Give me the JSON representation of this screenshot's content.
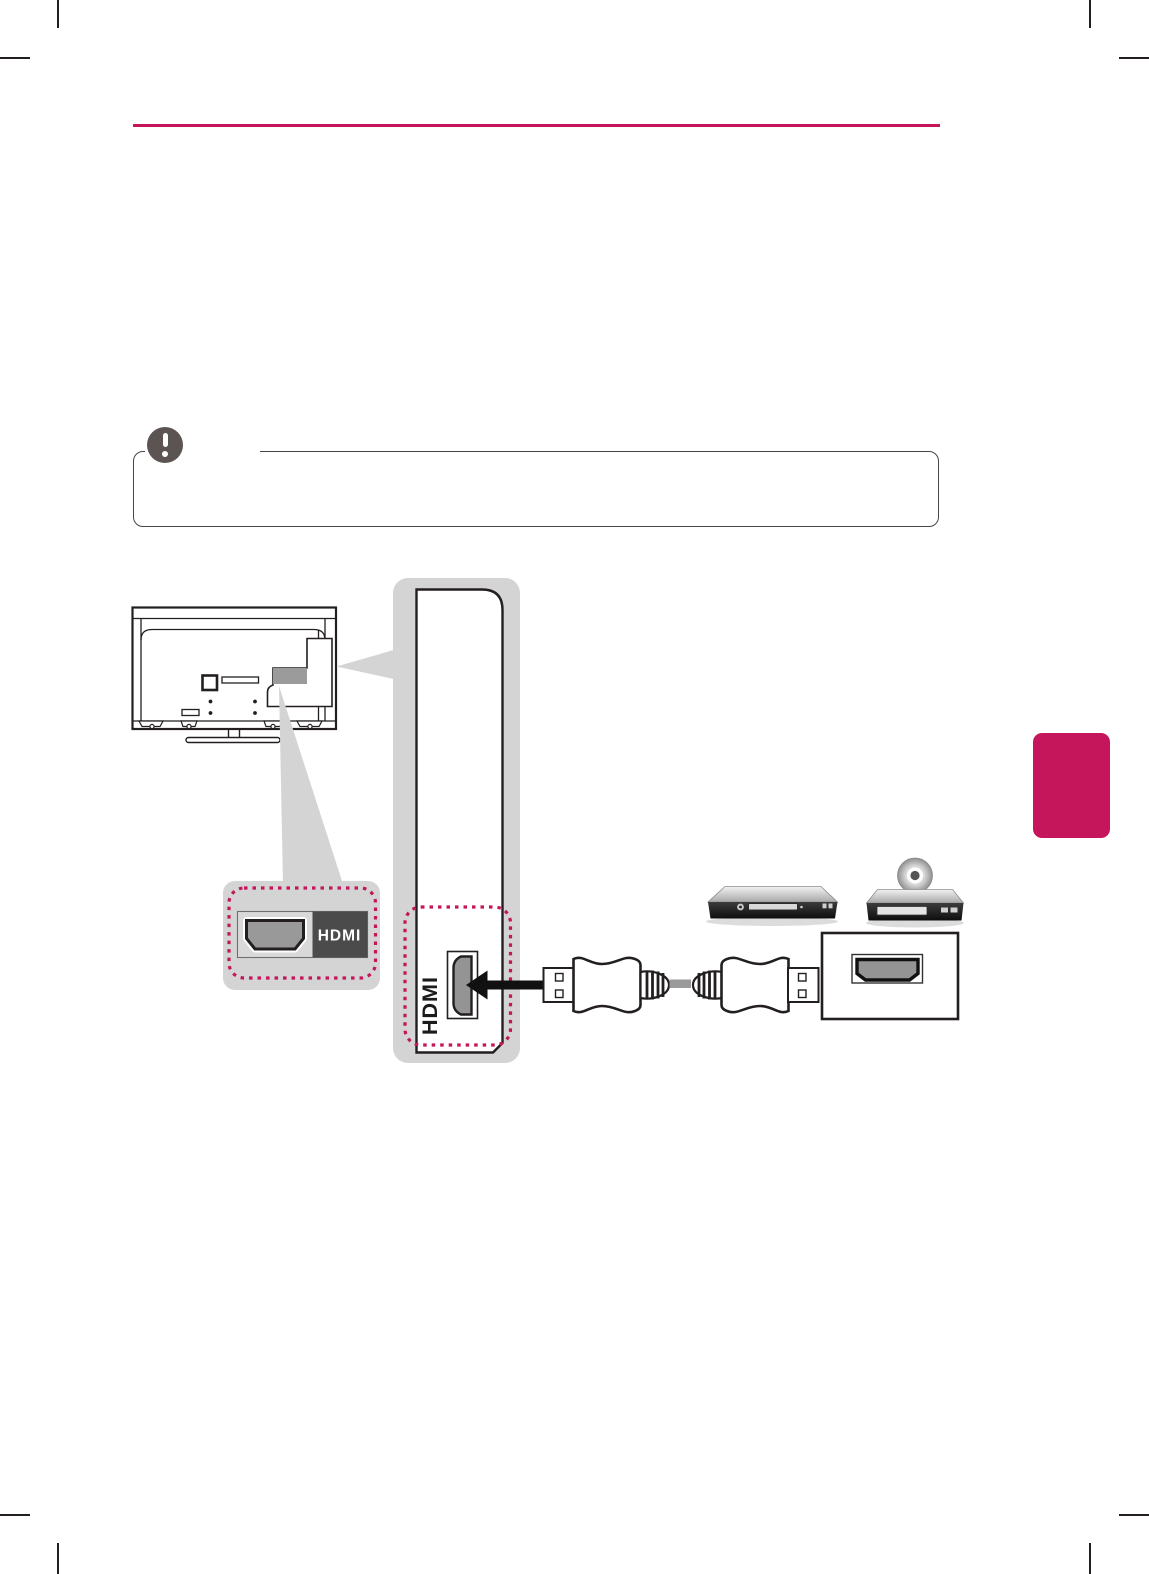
{
  "page": {
    "width": 1149,
    "height": 1574,
    "background": "#ffffff"
  },
  "colors": {
    "accent_magenta": "#c5155b",
    "outline_black": "#231f20",
    "callout_gray": "#d4d4d4",
    "note_border": "#4a4442",
    "note_icon_gray": "#5b5452",
    "hdmi_badge_bg": "#4b4b4b",
    "port_fill": "#949494",
    "cable_center_gray": "#9a9a9a"
  },
  "header": {
    "rule_present": true
  },
  "note_box": {
    "icon": "exclamation-icon",
    "title_text": ""
  },
  "side_tab": {
    "text": ""
  },
  "diagram": {
    "tv_badge_label": "HDMI",
    "panel_port_label": "HDMI",
    "components": [
      "tv-rear-view",
      "hdmi-port-detail-callout",
      "rear-panel-zoom",
      "left-arrow",
      "hdmi-cable",
      "set-top-box",
      "disc-player",
      "device-hdmi-port"
    ]
  }
}
